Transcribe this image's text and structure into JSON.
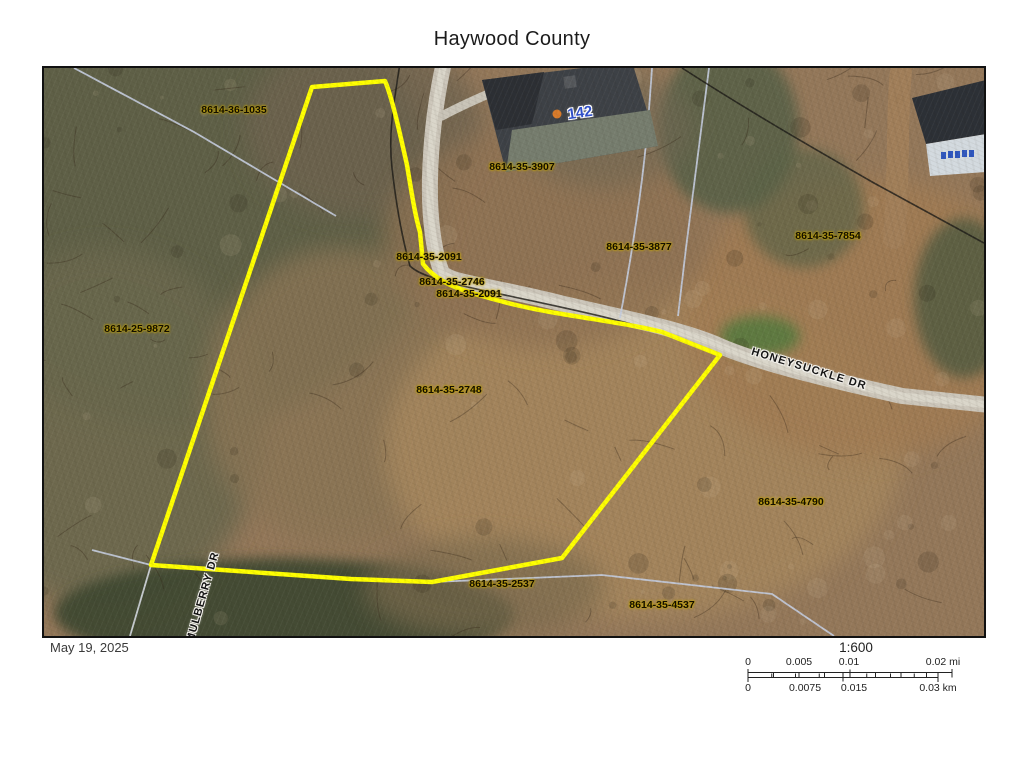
{
  "title": "Haywood County",
  "map": {
    "highlight_color": "#ffff00",
    "parcel_labels": [
      {
        "text": "8614-36-1035",
        "x": 190,
        "y": 42
      },
      {
        "text": "8614-35-3907",
        "x": 478,
        "y": 99
      },
      {
        "text": "8614-35-2091",
        "x": 385,
        "y": 189
      },
      {
        "text": "8614-35-2746",
        "x": 408,
        "y": 214
      },
      {
        "text": "8614-35-2091",
        "x": 425,
        "y": 226
      },
      {
        "text": "8614-35-3877",
        "x": 595,
        "y": 179
      },
      {
        "text": "8614-35-7854",
        "x": 784,
        "y": 168
      },
      {
        "text": "8614-25-9872",
        "x": 93,
        "y": 261
      },
      {
        "text": "8614-35-2748",
        "x": 405,
        "y": 322
      },
      {
        "text": "8614-35-4790",
        "x": 747,
        "y": 434
      },
      {
        "text": "8614-35-2537",
        "x": 458,
        "y": 516
      },
      {
        "text": "8614-35-4537",
        "x": 618,
        "y": 537
      }
    ],
    "road_labels": [
      {
        "text": "HONEYSUCKLE DR",
        "x": 765,
        "y": 301,
        "rot": 17
      },
      {
        "text": "MULBERRY DR",
        "x": 159,
        "y": 529,
        "rot": -74
      }
    ],
    "house_number": {
      "text": "142",
      "x": 536,
      "y": 45,
      "rot": -8
    }
  },
  "footer": {
    "date": "May 19, 2025",
    "scale_ratio": "1:600",
    "scale_mi": [
      {
        "text": "0",
        "x": 6
      },
      {
        "text": "0.005",
        "x": 57
      },
      {
        "text": "0.01",
        "x": 107
      },
      {
        "text": "0.02 mi",
        "x": 201
      }
    ],
    "scale_km": [
      {
        "text": "0",
        "x": 6
      },
      {
        "text": "0.0075",
        "x": 63
      },
      {
        "text": "0.015",
        "x": 112
      },
      {
        "text": "0.03 km",
        "x": 196
      }
    ]
  }
}
